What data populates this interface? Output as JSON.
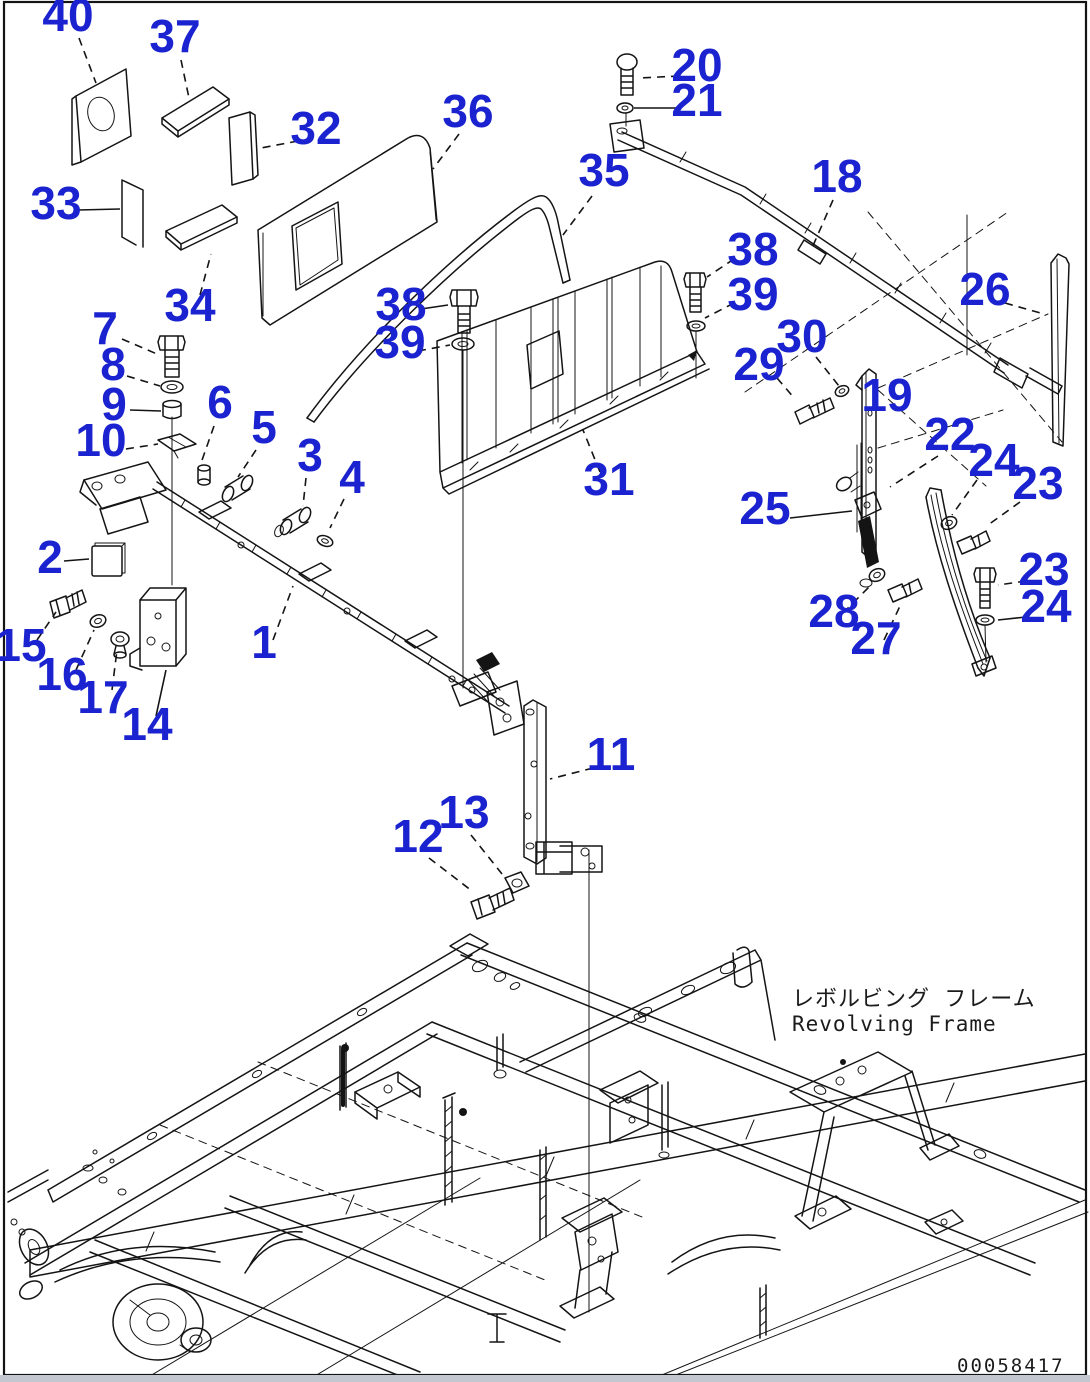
{
  "figure": {
    "title_ja": "レボルビング フレーム",
    "title_en": "Revolving Frame",
    "drawing_number": "00058417"
  },
  "style": {
    "callout_color": "#1a23cf",
    "line_color": "#141414",
    "footer_strip_color": "#c3c7cf",
    "background": "#ffffff"
  },
  "callouts": [
    {
      "t": "40",
      "x": 68,
      "y": 31,
      "l": [
        79,
        38,
        96,
        83
      ],
      "d": 1
    },
    {
      "t": "37",
      "x": 175,
      "y": 52,
      "l": [
        181,
        60,
        189,
        98
      ],
      "d": 1
    },
    {
      "t": "32",
      "x": 316,
      "y": 144,
      "l": [
        298,
        141,
        261,
        148
      ],
      "d": 1
    },
    {
      "t": "36",
      "x": 468,
      "y": 127,
      "l": [
        459,
        134,
        433,
        169
      ],
      "d": 1
    },
    {
      "t": "33",
      "x": 56,
      "y": 219,
      "l": [
        78,
        210,
        120,
        209
      ],
      "d": 0
    },
    {
      "t": "34",
      "x": 190,
      "y": 321,
      "l": [
        200,
        295,
        211,
        254
      ],
      "d": 1
    },
    {
      "t": "20",
      "x": 697,
      "y": 81,
      "l": [
        679,
        76,
        640,
        78
      ],
      "d": 1
    },
    {
      "t": "21",
      "x": 697,
      "y": 116,
      "l": [
        678,
        108,
        634,
        108
      ],
      "d": 0
    },
    {
      "t": "35",
      "x": 604,
      "y": 186,
      "l": [
        592,
        196,
        563,
        235
      ],
      "d": 1
    },
    {
      "t": "18",
      "x": 837,
      "y": 192,
      "l": [
        833,
        200,
        812,
        248
      ],
      "d": 1
    },
    {
      "t": "26",
      "x": 985,
      "y": 305,
      "l": [
        1005,
        303,
        1044,
        314
      ],
      "d": 1
    },
    {
      "t": "38",
      "x": 401,
      "y": 320,
      "l": [
        421,
        309,
        448,
        305
      ],
      "d": 0
    },
    {
      "t": "39",
      "x": 400,
      "y": 358,
      "l": [
        418,
        351,
        450,
        345
      ],
      "d": 1
    },
    {
      "t": "38",
      "x": 753,
      "y": 265,
      "l": [
        734,
        259,
        707,
        277
      ],
      "d": 1
    },
    {
      "t": "39",
      "x": 753,
      "y": 310,
      "l": [
        734,
        303,
        705,
        318
      ],
      "d": 1
    },
    {
      "t": "7",
      "x": 105,
      "y": 344,
      "l": [
        122,
        339,
        157,
        354
      ],
      "d": 1
    },
    {
      "t": "8",
      "x": 113,
      "y": 380,
      "l": [
        127,
        376,
        160,
        386
      ],
      "d": 1
    },
    {
      "t": "9",
      "x": 114,
      "y": 420,
      "l": [
        130,
        410,
        161,
        411
      ],
      "d": 0
    },
    {
      "t": "10",
      "x": 101,
      "y": 456,
      "l": [
        126,
        449,
        158,
        444
      ],
      "d": 1
    },
    {
      "t": "6",
      "x": 220,
      "y": 418,
      "l": [
        214,
        426,
        201,
        463
      ],
      "d": 1
    },
    {
      "t": "5",
      "x": 264,
      "y": 443,
      "l": [
        256,
        450,
        238,
        477
      ],
      "d": 1
    },
    {
      "t": "3",
      "x": 310,
      "y": 471,
      "l": [
        306,
        478,
        303,
        506
      ],
      "d": 1
    },
    {
      "t": "4",
      "x": 352,
      "y": 493,
      "l": [
        344,
        499,
        330,
        528
      ],
      "d": 1
    },
    {
      "t": "2",
      "x": 50,
      "y": 573,
      "l": [
        64,
        561,
        89,
        559
      ],
      "d": 0
    },
    {
      "t": "29",
      "x": 759,
      "y": 380,
      "l": [
        777,
        378,
        795,
        399
      ],
      "d": 1
    },
    {
      "t": "30",
      "x": 802,
      "y": 352,
      "l": [
        816,
        357,
        839,
        386
      ],
      "d": 1
    },
    {
      "t": "19",
      "x": 887,
      "y": 411,
      "l": null,
      "d": 0
    },
    {
      "t": "22",
      "x": 950,
      "y": 450,
      "l": [
        938,
        456,
        890,
        487
      ],
      "d": 1
    },
    {
      "t": "24",
      "x": 994,
      "y": 476,
      "l": [
        977,
        480,
        952,
        515
      ],
      "d": 1
    },
    {
      "t": "23",
      "x": 1038,
      "y": 499,
      "l": [
        1020,
        502,
        988,
        525
      ],
      "d": 1
    },
    {
      "t": "25",
      "x": 765,
      "y": 524,
      "l": [
        790,
        518,
        852,
        511
      ],
      "d": 0
    },
    {
      "t": "23",
      "x": 1044,
      "y": 585,
      "l": [
        1026,
        581,
        998,
        585
      ],
      "d": 1
    },
    {
      "t": "24",
      "x": 1046,
      "y": 622,
      "l": [
        1026,
        617,
        998,
        620
      ],
      "d": 0
    },
    {
      "t": "28",
      "x": 834,
      "y": 627,
      "l": [
        843,
        613,
        871,
        585
      ],
      "d": 1
    },
    {
      "t": "27",
      "x": 876,
      "y": 654,
      "l": [
        884,
        640,
        900,
        606
      ],
      "d": 1
    },
    {
      "t": "31",
      "x": 609,
      "y": 495,
      "l": [
        600,
        472,
        583,
        430
      ],
      "d": 1
    },
    {
      "t": "1",
      "x": 264,
      "y": 658,
      "l": [
        273,
        640,
        293,
        586
      ],
      "d": 1
    },
    {
      "t": "15",
      "x": 21,
      "y": 661,
      "l": [
        37,
        640,
        56,
        612
      ],
      "d": 1
    },
    {
      "t": "16",
      "x": 62,
      "y": 690,
      "l": [
        76,
        670,
        94,
        630
      ],
      "d": 1
    },
    {
      "t": "17",
      "x": 103,
      "y": 713,
      "l": [
        112,
        690,
        117,
        650
      ],
      "d": 1
    },
    {
      "t": "14",
      "x": 147,
      "y": 740,
      "l": [
        156,
        716,
        166,
        670
      ],
      "d": 0
    },
    {
      "t": "11",
      "x": 611,
      "y": 770,
      "l": [
        593,
        768,
        550,
        779
      ],
      "d": 1
    },
    {
      "t": "13",
      "x": 464,
      "y": 828,
      "l": [
        471,
        835,
        502,
        874
      ],
      "d": 1
    },
    {
      "t": "12",
      "x": 418,
      "y": 852,
      "l": [
        429,
        858,
        472,
        891
      ],
      "d": 1
    }
  ]
}
